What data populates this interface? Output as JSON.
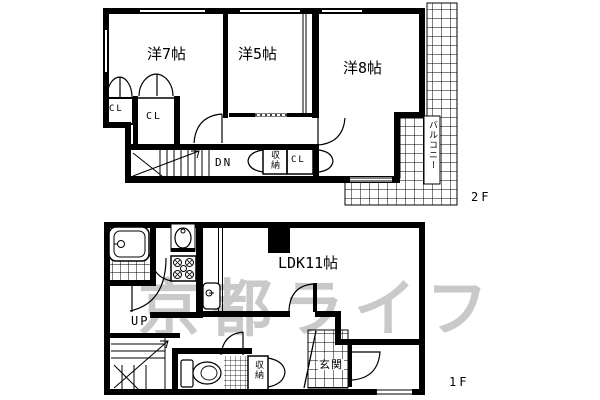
{
  "title": "2-story apartment floor plan",
  "watermark": "京都ライフ",
  "colors": {
    "background": "#ffffff",
    "line": "#000000",
    "watermark": "#c9c9c9"
  },
  "floors": {
    "f2": {
      "label": "2F",
      "rooms": {
        "west7": "洋7帖",
        "west5": "洋5帖",
        "west8": "洋8帖",
        "cl_small": "CL",
        "cl_main": "CL",
        "storage": "収納",
        "cl_hall": "CL",
        "balcony": "バルコニー",
        "stairs_down": "DN"
      }
    },
    "f1": {
      "label": "1F",
      "rooms": {
        "ldk": "LDK11帖",
        "stairs_up": "UP",
        "storage": "収納",
        "entrance": "玄関"
      }
    }
  },
  "icons": {
    "bathtub": "bathtub-icon",
    "washbasin": "washbasin-icon",
    "laundry_pan": "laundry-pan-icon",
    "kitchen_sink": "kitchen-sink-icon",
    "toilet": "toilet-icon"
  }
}
